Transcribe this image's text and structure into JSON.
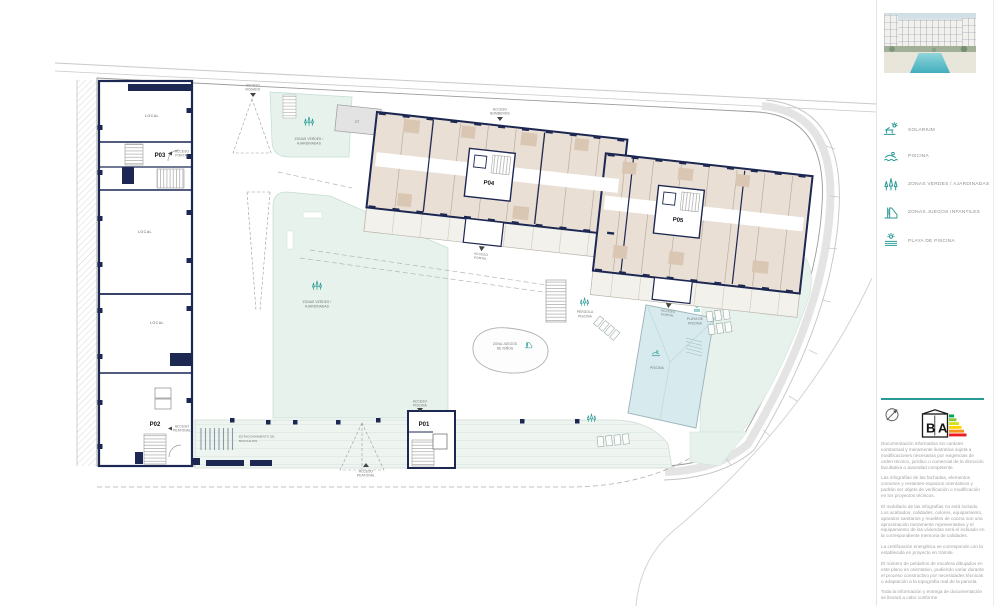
{
  "legend": {
    "items": [
      {
        "icon": "solarium-icon",
        "label": "SOLARIUM"
      },
      {
        "icon": "swimmer-icon",
        "label": "PISCINA"
      },
      {
        "icon": "trees-icon",
        "label": "ZONAS VERDES / AJARDINADAS"
      },
      {
        "icon": "slide-icon",
        "label": "ZONAS JUEGOS INFANTILES"
      },
      {
        "icon": "pool-beach-icon",
        "label": "PLAYA DE PISCINA"
      }
    ]
  },
  "branding": {
    "energy_letters": [
      "B",
      "A"
    ]
  },
  "disclaimer": {
    "paragraphs": [
      "Documentación informativa sin carácter contractual y meramente ilustrativa sujeta a modificaciones necesarias por exigencias de orden técnico, jurídico o comercial de la dirección facultativa o autoridad competente.",
      "Las infografías de las fachadas, elementos comunes y restantes espacios orientativos y podrán ser objeto de verificación o modificación en los proyectos técnicos.",
      "El mobiliario de las infografías no está incluido. Los acabados, calidades, colores, equipamiento, aparatos sanitarios y muebles de cocina son una aproximación meramente representativa y el equipamiento de las viviendas será el indicado en la correspondiente memoria de calidades.",
      "La certificación energética se corresponde con la establecida en proyecto en trámite.",
      "El número de peldaños de escalera dibujados en este plano es orientativo, pudiendo variar durante el proceso constructivo por necesidades técnicas o adaptación a la topografía real de la parcela.",
      "Toda la información y entrega de documentación se llevará a cabo conforme"
    ]
  },
  "plan": {
    "portals": {
      "p01": "P01",
      "p02": "P02",
      "p03": "P03",
      "p04": "P04",
      "p05": "P05"
    },
    "rooms": {
      "local": "LOCAL",
      "ct": "CT"
    },
    "labels": {
      "acceso_rodado": [
        "ACCESO",
        "RODADO"
      ],
      "acceso_bomberos": [
        "ACCESO",
        "BOMBEROS"
      ],
      "acceso_portal": [
        "ACCESO",
        "PORTAL"
      ],
      "acceso_peatonal": [
        "ACCESO",
        "PEATONAL"
      ],
      "acceso_piscina": [
        "ACCESO",
        "PISCINA"
      ],
      "zonas_verdes": [
        "ZONAS VERDES /",
        "AJARDINADAS"
      ],
      "zona_juegos": [
        "ZONA JUEGOS",
        "DE NIÑOS"
      ],
      "pergola_piscina": [
        "PÉRGOLA",
        "PISCINA"
      ],
      "playa_de_piscina": [
        "PLAYA DE",
        "PISCINA"
      ],
      "piscina": "PISCINA",
      "estacionamiento": [
        "ESTACIONAMIENTO DE",
        "BICICLETAS"
      ]
    },
    "colors": {
      "wall": "#1c2752",
      "apartment_fill": "#e9dfd4",
      "green_zone": "#e7f2ec",
      "pool": "#d7ebee",
      "accent_teal": "#2a9a96"
    }
  }
}
